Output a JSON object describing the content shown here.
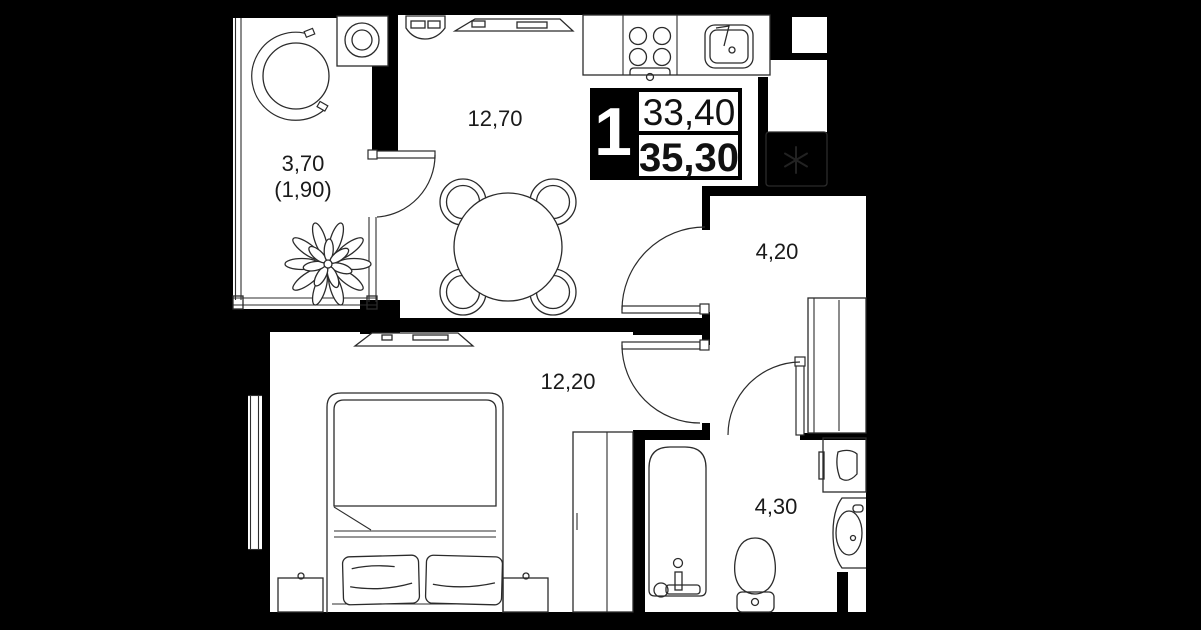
{
  "floor_plan": {
    "unit_info": {
      "rooms_count": "1",
      "area_living": "33,40",
      "area_total": "35,30"
    },
    "rooms": [
      {
        "name": "balcony",
        "area": "3,70",
        "area_reduced": "(1,90)"
      },
      {
        "name": "kitchen-living-room",
        "area": "12,70"
      },
      {
        "name": "hallway",
        "area": "4,20"
      },
      {
        "name": "bedroom",
        "area": "12,20"
      },
      {
        "name": "bathroom",
        "area": "4,30"
      }
    ],
    "symbols": {
      "shaft_marker": "asterisk"
    },
    "colors": {
      "background": "#000000",
      "floor": "#ffffff",
      "lines": "#2b2b2b"
    }
  }
}
